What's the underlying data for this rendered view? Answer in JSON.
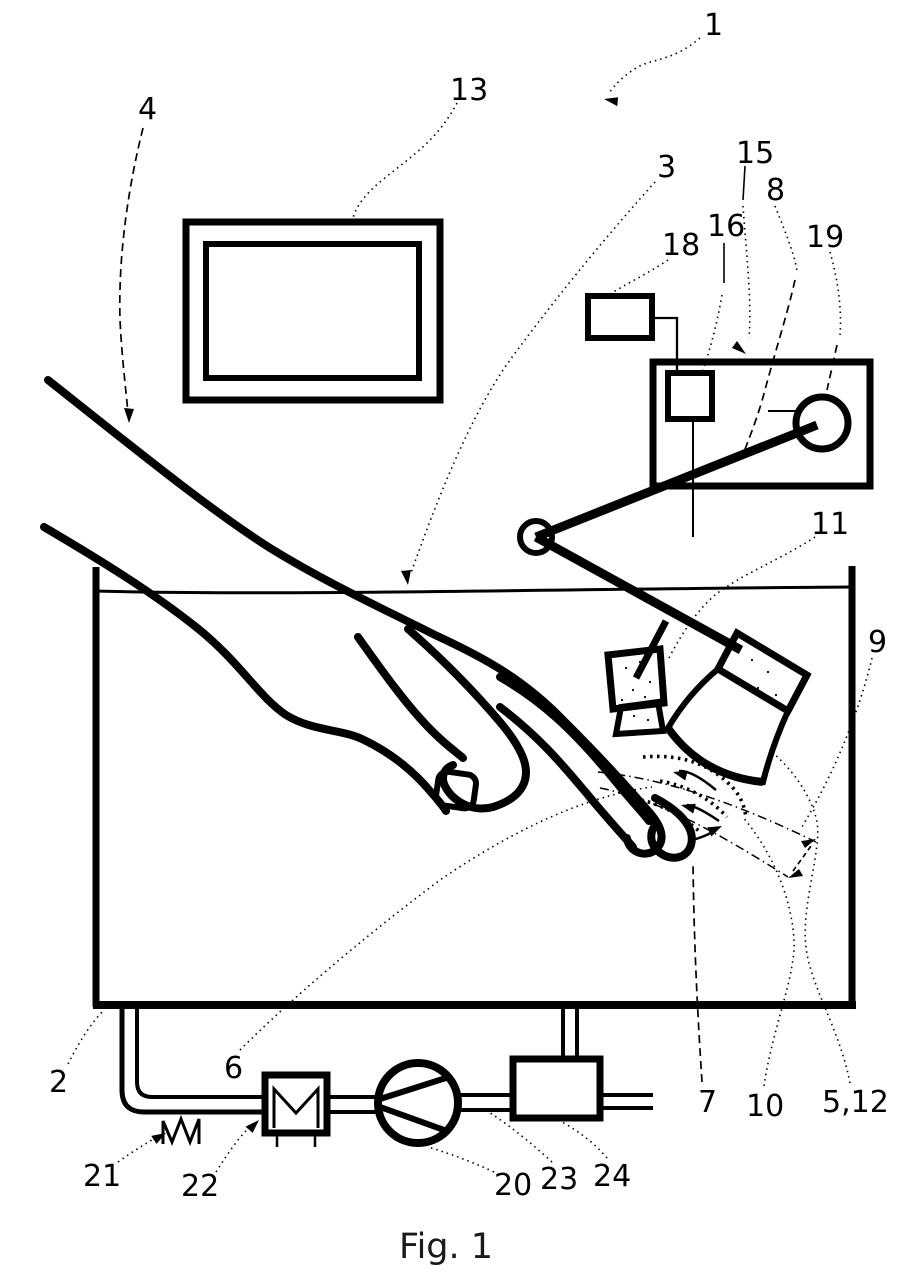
{
  "figure": {
    "caption": "Fig. 1"
  },
  "colors": {
    "line": "#000000",
    "background": "#ffffff"
  },
  "labels": {
    "n1": {
      "text": "1"
    },
    "n2": {
      "text": "2"
    },
    "n3": {
      "text": "3"
    },
    "n4": {
      "text": "4"
    },
    "n6": {
      "text": "6"
    },
    "n7": {
      "text": "7"
    },
    "n8": {
      "text": "8"
    },
    "n9": {
      "text": "9"
    },
    "n10": {
      "text": "10"
    },
    "n11": {
      "text": "11"
    },
    "n13": {
      "text": "13"
    },
    "n15": {
      "text": "15"
    },
    "n16": {
      "text": "16"
    },
    "n18": {
      "text": "18"
    },
    "n19": {
      "text": "19"
    },
    "n20": {
      "text": "20"
    },
    "n21": {
      "text": "21"
    },
    "n22": {
      "text": "22"
    },
    "n23": {
      "text": "23"
    },
    "n24": {
      "text": "24"
    },
    "n512": {
      "text": "5,12"
    }
  }
}
